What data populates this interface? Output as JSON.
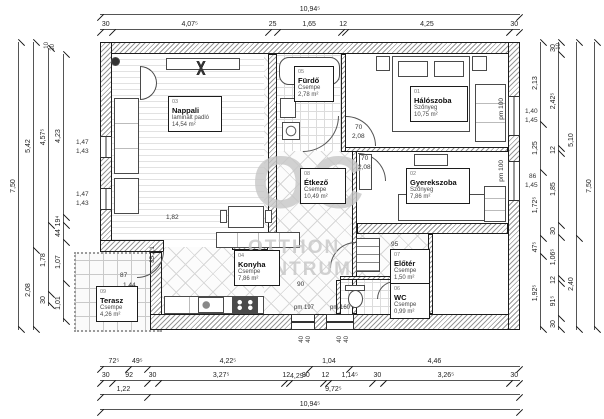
{
  "watermark": {
    "initials": "OC",
    "line1": "OTTHON",
    "line2": "CENTRUM"
  },
  "rooms": {
    "nappali": {
      "num": "03",
      "name": "Nappali",
      "floor": "laminált padló",
      "area": "14,54 m²"
    },
    "furdo": {
      "num": "05",
      "name": "Fürdő",
      "floor": "Csempe",
      "area": "2,78 m²"
    },
    "haloszoba": {
      "num": "01",
      "name": "Hálószoba",
      "floor": "Szőnyeg",
      "area": "10,75 m²"
    },
    "etkezo": {
      "num": "08",
      "name": "Étkező",
      "floor": "Csempe",
      "area": "10,49 m²"
    },
    "gyerekszoba": {
      "num": "02",
      "name": "Gyerekszoba",
      "floor": "Szőnyeg",
      "area": "7,86 m²"
    },
    "konyha": {
      "num": "04",
      "name": "Konyha",
      "floor": "Csempe",
      "area": "7,86 m²"
    },
    "eloter": {
      "num": "07",
      "name": "Előtér",
      "floor": "Csempe",
      "area": "1,50 m²"
    },
    "wc": {
      "num": "06",
      "name": "WC",
      "floor": "Csempe",
      "area": "0,99 m²"
    },
    "terasz": {
      "num": "09",
      "name": "Terasz",
      "floor": "Csempe",
      "area": "4,26 m²"
    }
  },
  "dims": {
    "top_total": "10,94⁵",
    "top": [
      "30",
      "4,07⁵",
      "25",
      "1,65",
      "12",
      "4,25",
      "30"
    ],
    "bottom1": [
      "72⁵",
      "49⁵",
      "4,22⁵",
      "1,04",
      "4,46"
    ],
    "bottom2": [
      "30",
      "92",
      "30",
      "3,27⁵",
      "12",
      "90",
      "12",
      "1,14⁵",
      "30",
      "3,26⁵",
      "30"
    ],
    "bottom2_overlay": "4,29⁵",
    "bottom3": [
      "1,22",
      "9,72⁵"
    ],
    "bottom_total": "10,94⁵",
    "left1": "7,50",
    "left2": [
      "5,42",
      "2,08"
    ],
    "left3": [
      "4,57⁵",
      "1,78",
      "30"
    ],
    "left4": [
      "4,23",
      "19⁴",
      "44",
      "1,07",
      "1,01"
    ],
    "left_small_a": "10",
    "left_small_b": "30",
    "right1": [
      "2,13",
      "1,25",
      "1,72⁵",
      "47⁵",
      "1,92⁵"
    ],
    "right2": [
      "30",
      "2,42⁵",
      "12",
      "1,85",
      "30",
      "1,06⁵",
      "12",
      "91⁵",
      "30"
    ],
    "right_small_a": "10",
    "right_small_b": "30",
    "right3": [
      "5,10",
      "2,40"
    ],
    "right_total": "7,50"
  },
  "annot": {
    "win_l1a": "1,47",
    "win_l1b": "1,43",
    "win_l2a": "1,47",
    "win_l2b": "1,43",
    "win_r1a": "1,40",
    "win_r1b": "1,45",
    "win_r2a": "86",
    "win_r2b": "1,45",
    "door_halo_a": "70",
    "door_halo_b": "2,08",
    "door_gyerek_a": "70",
    "door_gyerek_b": "2,08",
    "nappali_opening": "1,82",
    "eloter_w": "95",
    "konyha_door": "90",
    "terasz_door_a": "87",
    "terasz_door_b": "1,44",
    "terasz_side": "85 2,1",
    "pm100": "pm 100",
    "pm197": "pm 197",
    "pm160": "pm 160",
    "forty": "40"
  }
}
